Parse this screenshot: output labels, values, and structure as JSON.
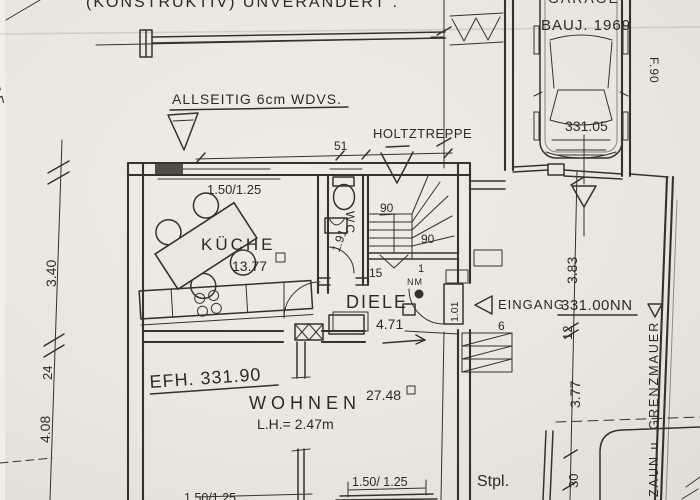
{
  "colors": {
    "paper": "#eae7e1",
    "ink": "#34322c"
  },
  "labels": {
    "top_note": "(KONSTRUKTIV) UNVERÄNDERT .",
    "grenze": "GRENZE",
    "wdvs": "ALLSEITIG 6cm WDVS.",
    "holztreppe": "HOLTZTREPPE",
    "garage_hidden": "GARAGE",
    "baujahr": "BAUJ. 1969",
    "garage_level": "331.05",
    "f90": "F.90",
    "kueche": "KÜCHE",
    "kueche_area": "13.77",
    "wc": "WC",
    "wc_width": "1.91",
    "diele": "DIELE",
    "diele_area": "4.71",
    "door_width": "1.01",
    "stairs_marker": "NM",
    "eingang": "EINGANG",
    "eingang_level": "331.00NN",
    "efh_level": "EFH. 331.90",
    "wohnen": "WOHNEN",
    "wohnen_area": "27.48",
    "wohnen_height": "L.H.= 2.47m",
    "zaun": "ZAUN u. GRENZMAUER",
    "stpl": "Stpl."
  },
  "dims": {
    "d51": "51",
    "win_top": "1.50/1.25",
    "win_bottom_left": "1.50/1.25",
    "win_bottom_mid": "1.50/ 1.25",
    "d90a": "90",
    "d90b": "90",
    "d15": "15",
    "d1": "1",
    "d6": "6",
    "d12": "12",
    "left_340": "3.40",
    "left_24": "24",
    "left_408": "4.08",
    "right_383": "3.83",
    "right_377": "3.77",
    "right_30": "30"
  }
}
